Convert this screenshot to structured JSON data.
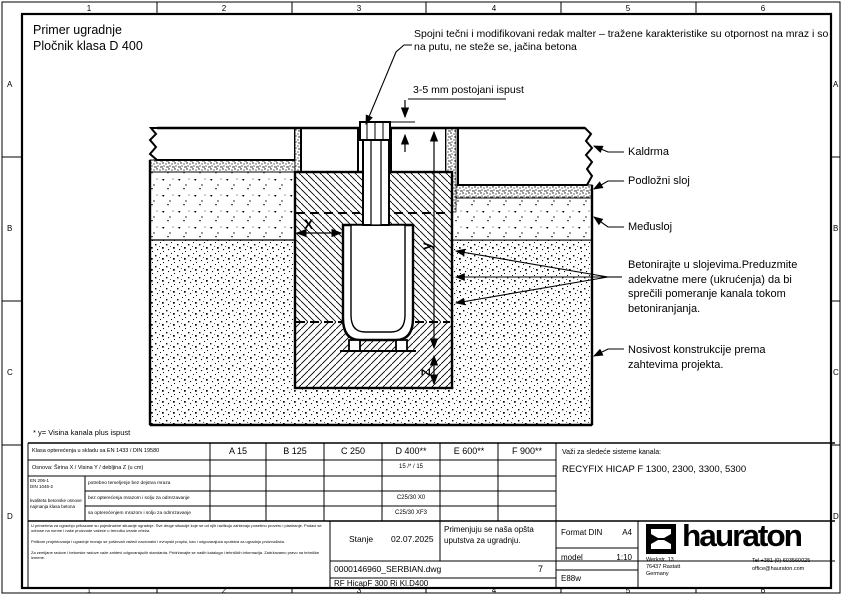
{
  "frame": {
    "columns": [
      "1",
      "2",
      "3",
      "4",
      "5",
      "6"
    ],
    "rows": [
      "A",
      "B",
      "C",
      "D"
    ]
  },
  "header": {
    "title_line1": "Primer ugradnje",
    "title_line2": "Pločnik klasa D 400"
  },
  "drawing": {
    "joint_note": "Spojni tečni i modifikovani redak malter – tražene karakteristike su otpornost na mraz i so na putu, ne steže se, jačina betona",
    "gap_note": "3-5 mm postojani ispust",
    "labels": {
      "kaldrma": "Kaldrma",
      "podlozni_sloj": "Podložni sloj",
      "medjusloj": "Međusloj",
      "betoniranje": "Betonirajte u slojevima.Preduzmite adekvatne mere (ukrućenja) da bi sprečili pomeranje kanala tokom betoniranjanja.",
      "nosivost": "Nosivost konstrukcije prema zahtevima projekta."
    },
    "dims": {
      "x": "X",
      "y": "y",
      "z": "Z"
    }
  },
  "footnote": "* y= Visina kanala plus ispust",
  "load_table": {
    "class_row_label": "Klasa opterećenja u skladu sa EN 1433 / DIN 19580",
    "classes": [
      "A 15",
      "B 125",
      "C 250",
      "D 400**",
      "E 600**",
      "F 900**"
    ],
    "osnova_label": "Osnova: Širina X / Visina Y / debljina Z (u cm)",
    "osnova_d400": "15 /* / 15",
    "beton_group": [
      "EN 206-1",
      "DIN 1045-2",
      "kvaliteta betonske osnove",
      "najmanja klasa betona"
    ],
    "beton_rows": [
      "potrebno temeljenje bez dejstva mraza",
      "bez opterećenja mrazom i solju za odmrzavanje",
      "sa opterećenjem mrazom i solju za odmrzavanje"
    ],
    "beton_d400": [
      "",
      "C25/30 X0",
      "C25/30 XF3"
    ],
    "systems_label": "Važi za sledeće sisteme kanala:",
    "systems": "RECYFIX HICAP F 1300, 2300, 3300, 5300"
  },
  "titleblock": {
    "disclaimer": [
      "U primerima za ugradnju prikazane su pojedinačne situacije ugradnje. Sve druge situacije koje se od njih razlikuju zahtevaju posebnu proveru i planiranje. Podaci se odnose na norme i naše proizvode važeće u trenutku izrade crteža.",
      "Prilikom projektovanja i ugradnje moraju se poštovati važeći nacionalni i evropski propisi, kao i odgovarajuća uputstva za ugradnju proizvođača.",
      "Za zemljane radove i betonske radove važe zahtevi odgovarajućih standarda. Pridržavajte se naših kataloga i tehničkih informacija. Zadržavamo pravo na tehničke izmene."
    ],
    "stanje_label": "Stanje",
    "stanje_date": "02.07.2025",
    "note": "Primenjuju se naša opšta uputstva za ugradnju.",
    "format_label": "Format DIN",
    "format_value": "A4",
    "scale_label": "model",
    "scale_value": "1:10",
    "code": "E88w",
    "file_name": "0000146960_SERBIAN.dwg",
    "page": "7",
    "drawing_name": "RF HicapF 300 Ri Kl.D400",
    "brand": "hauraton",
    "address": [
      "Werkstr. 13",
      "76437 Rastatt",
      "Germany"
    ],
    "phone": "Tel +381 (0) 603560025",
    "email": "office@hauraton.com"
  }
}
